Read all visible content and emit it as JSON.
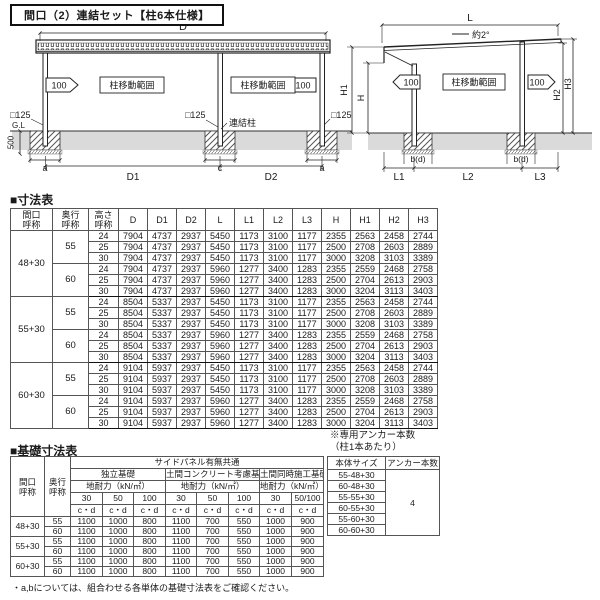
{
  "title": "間口（2）連結セット【柱6本仕様】",
  "front_view": {
    "dim_d": "D",
    "dim_d1": "D1",
    "dim_d2": "D2",
    "arrow_left_label": "100",
    "arrow_right_label": "100",
    "range_left": "柱移動範囲",
    "range_right": "柱移動範囲",
    "post_left": "□125",
    "post_center": "□125",
    "post_right": "□125",
    "gl": "G.L",
    "depth": "500",
    "joint_post": "連結柱",
    "footing_a_left": "a",
    "footing_c": "c",
    "footing_a_right": "a"
  },
  "side_view": {
    "dim_l": "L",
    "slope": "約2°",
    "arrow_left_label": "100",
    "arrow_right_label": "100",
    "range": "柱移動範囲",
    "dim_h": "H",
    "dim_h1": "H1",
    "dim_h2": "H2",
    "dim_h3": "H3",
    "footing_left": "b(d)",
    "footing_right": "b(d)",
    "dim_l1": "L1",
    "dim_l2": "L2",
    "dim_l3": "L3"
  },
  "dim_table": {
    "section_title": "■寸法表",
    "headers": [
      "間口\n呼称",
      "奥行\n呼称",
      "高さ\n呼称",
      "D",
      "D1",
      "D2",
      "L",
      "L1",
      "L2",
      "L3",
      "H",
      "H1",
      "H2",
      "H3"
    ],
    "groups": [
      {
        "span_label": "48+30",
        "sub": [
          {
            "label": "55",
            "rows": [
              [
                "24",
                "7904",
                "4737",
                "2937",
                "5450",
                "1173",
                "3100",
                "1177",
                "2355",
                "2563",
                "2458",
                "2744"
              ],
              [
                "25",
                "7904",
                "4737",
                "2937",
                "5450",
                "1173",
                "3100",
                "1177",
                "2500",
                "2708",
                "2603",
                "2889"
              ],
              [
                "30",
                "7904",
                "4737",
                "2937",
                "5450",
                "1173",
                "3100",
                "1177",
                "3000",
                "3208",
                "3103",
                "3389"
              ]
            ]
          },
          {
            "label": "60",
            "rows": [
              [
                "24",
                "7904",
                "4737",
                "2937",
                "5960",
                "1277",
                "3400",
                "1283",
                "2355",
                "2559",
                "2468",
                "2758"
              ],
              [
                "25",
                "7904",
                "4737",
                "2937",
                "5960",
                "1277",
                "3400",
                "1283",
                "2500",
                "2704",
                "2613",
                "2903"
              ],
              [
                "30",
                "7904",
                "4737",
                "2937",
                "5960",
                "1277",
                "3400",
                "1283",
                "3000",
                "3204",
                "3113",
                "3403"
              ]
            ]
          }
        ]
      },
      {
        "span_label": "55+30",
        "sub": [
          {
            "label": "55",
            "rows": [
              [
                "24",
                "8504",
                "5337",
                "2937",
                "5450",
                "1173",
                "3100",
                "1177",
                "2355",
                "2563",
                "2458",
                "2744"
              ],
              [
                "25",
                "8504",
                "5337",
                "2937",
                "5450",
                "1173",
                "3100",
                "1177",
                "2500",
                "2708",
                "2603",
                "2889"
              ],
              [
                "30",
                "8504",
                "5337",
                "2937",
                "5450",
                "1173",
                "3100",
                "1177",
                "3000",
                "3208",
                "3103",
                "3389"
              ]
            ]
          },
          {
            "label": "60",
            "rows": [
              [
                "24",
                "8504",
                "5337",
                "2937",
                "5960",
                "1277",
                "3400",
                "1283",
                "2355",
                "2559",
                "2468",
                "2758"
              ],
              [
                "25",
                "8504",
                "5337",
                "2937",
                "5960",
                "1277",
                "3400",
                "1283",
                "2500",
                "2704",
                "2613",
                "2903"
              ],
              [
                "30",
                "8504",
                "5337",
                "2937",
                "5960",
                "1277",
                "3400",
                "1283",
                "3000",
                "3204",
                "3113",
                "3403"
              ]
            ]
          }
        ]
      },
      {
        "span_label": "60+30",
        "sub": [
          {
            "label": "55",
            "rows": [
              [
                "24",
                "9104",
                "5937",
                "2937",
                "5450",
                "1173",
                "3100",
                "1177",
                "2355",
                "2563",
                "2458",
                "2744"
              ],
              [
                "25",
                "9104",
                "5937",
                "2937",
                "5450",
                "1173",
                "3100",
                "1177",
                "2500",
                "2708",
                "2603",
                "2889"
              ],
              [
                "30",
                "9104",
                "5937",
                "2937",
                "5450",
                "1173",
                "3100",
                "1177",
                "3000",
                "3208",
                "3103",
                "3389"
              ]
            ]
          },
          {
            "label": "60",
            "rows": [
              [
                "24",
                "9104",
                "5937",
                "2937",
                "5960",
                "1277",
                "3400",
                "1283",
                "2355",
                "2559",
                "2468",
                "2758"
              ],
              [
                "25",
                "9104",
                "5937",
                "2937",
                "5960",
                "1277",
                "3400",
                "1283",
                "2500",
                "2704",
                "2613",
                "2903"
              ],
              [
                "30",
                "9104",
                "5937",
                "2937",
                "5960",
                "1277",
                "3400",
                "1283",
                "3000",
                "3204",
                "3113",
                "3403"
              ]
            ]
          }
        ]
      }
    ]
  },
  "base_table": {
    "section_title": "■基礎寸法表",
    "maguchi_header": "間口\n呼称",
    "okuyuki_header": "奥行\n呼称",
    "span_header": "サイドパネル有無共通",
    "group_headers": [
      "独立基礎",
      "土間コンクリート考慮基礎",
      "土間同時施工基礎※"
    ],
    "sub_header": "地耐力（kN/㎡）",
    "strength_cols": [
      [
        "30",
        "50",
        "100"
      ],
      [
        "30",
        "50",
        "100"
      ],
      [
        "30",
        "50/100"
      ]
    ],
    "cd": "c・d",
    "rows": [
      {
        "maguchi": "48+30",
        "okuyuki": "55",
        "values": [
          "1100",
          "1000",
          "800",
          "1100",
          "700",
          "550",
          "1000",
          "900"
        ]
      },
      {
        "maguchi": "48+30",
        "okuyuki": "60",
        "values": [
          "1100",
          "1000",
          "800",
          "1100",
          "700",
          "550",
          "1000",
          "900"
        ]
      },
      {
        "maguchi": "55+30",
        "okuyuki": "55",
        "values": [
          "1100",
          "1000",
          "800",
          "1100",
          "700",
          "550",
          "1000",
          "900"
        ]
      },
      {
        "maguchi": "55+30",
        "okuyuki": "60",
        "values": [
          "1100",
          "1000",
          "800",
          "1100",
          "700",
          "550",
          "1000",
          "900"
        ]
      },
      {
        "maguchi": "60+30",
        "okuyuki": "55",
        "values": [
          "1100",
          "1000",
          "800",
          "1100",
          "700",
          "550",
          "1000",
          "900"
        ]
      },
      {
        "maguchi": "60+30",
        "okuyuki": "60",
        "values": [
          "1100",
          "1000",
          "800",
          "1100",
          "700",
          "550",
          "1000",
          "900"
        ]
      }
    ],
    "footnote": "・a,bについては、組合わせる各単体の基礎寸法表をご確認ください。"
  },
  "anchor_table": {
    "note": "※専用アンカー本数\n（柱1本あたり）",
    "size_header": "本体サイズ",
    "count_header": "アンカー本数",
    "sizes": [
      "55-48+30",
      "60-48+30",
      "55-55+30",
      "60-55+30",
      "55-60+30",
      "60-60+30"
    ],
    "count": "4"
  }
}
